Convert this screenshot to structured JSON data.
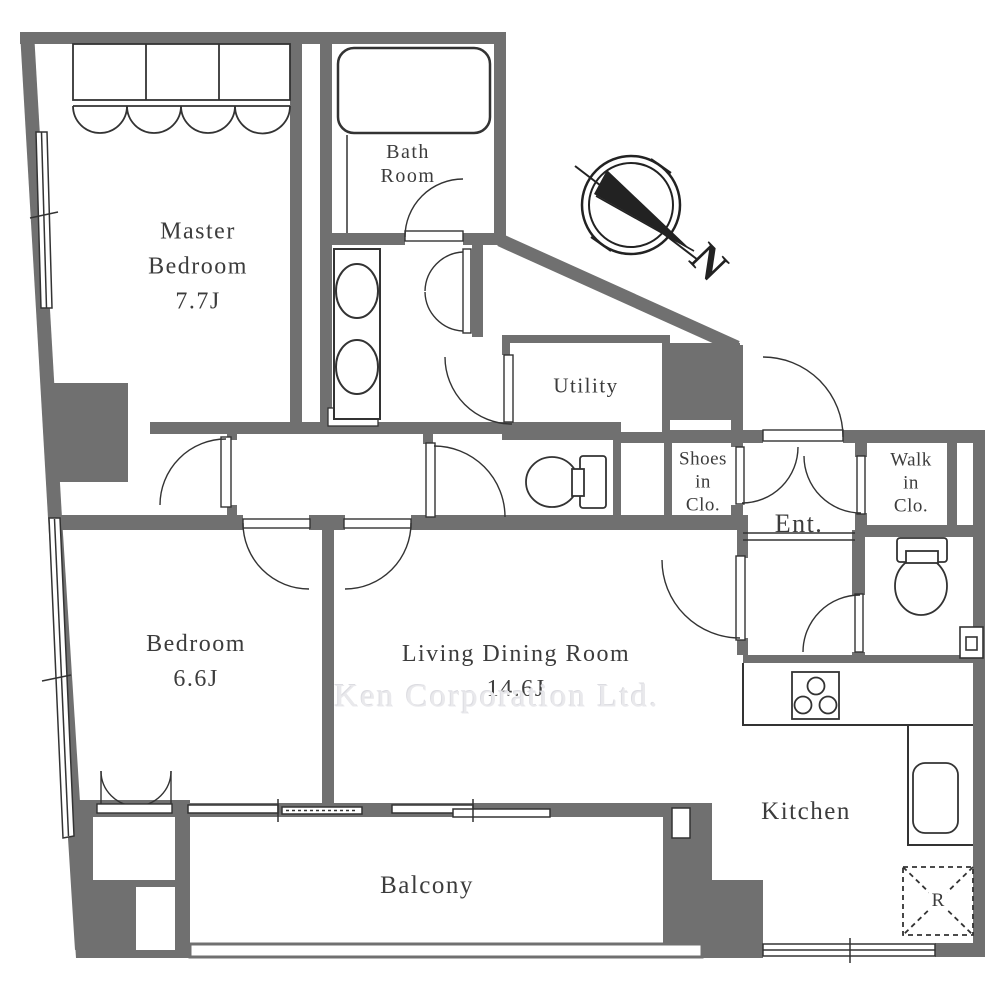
{
  "watermark": "Ken Corporation Ltd.",
  "compass": {
    "label": "N"
  },
  "rooms": {
    "master_bedroom": {
      "lines": [
        "Master",
        "Bedroom"
      ],
      "size": "7.7J"
    },
    "bath": {
      "lines": [
        "Bath",
        "Room"
      ]
    },
    "utility": {
      "name": "Utility"
    },
    "shoes_closet": {
      "lines": [
        "Shoes",
        "in",
        "Clo."
      ]
    },
    "walk_in_closet": {
      "lines": [
        "Walk",
        "in",
        "Clo."
      ]
    },
    "entrance": {
      "name": "Ent."
    },
    "bedroom": {
      "name": "Bedroom",
      "size": "6.6J"
    },
    "living_dining": {
      "name": "Living Dining Room",
      "size": "14.6J"
    },
    "kitchen": {
      "name": "Kitchen"
    },
    "balcony": {
      "name": "Balcony"
    }
  },
  "fixtures": {
    "refrigerator_label": "R"
  }
}
